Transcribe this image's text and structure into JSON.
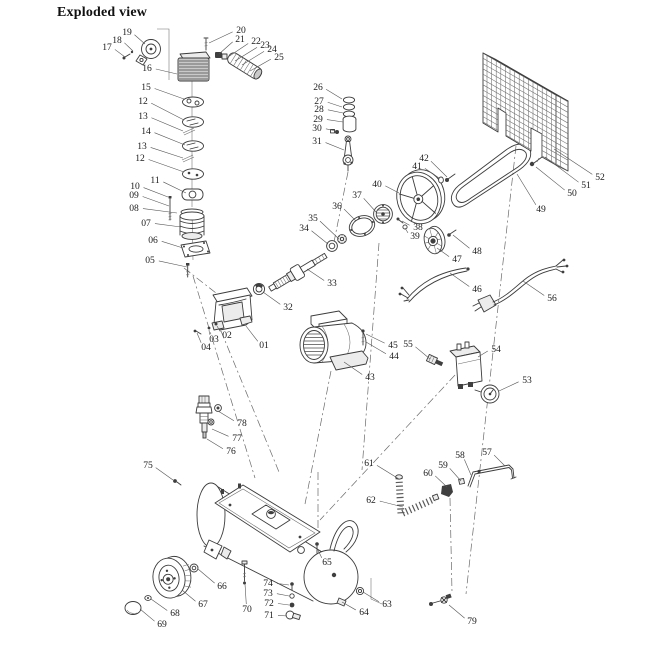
{
  "title": "Exploded view",
  "diagram": {
    "type": "exploded-parts-diagram",
    "subject": "belt-driven air compressor",
    "ink_color": "#3c3c3c",
    "label_color": "#1c1c1c",
    "labels": [
      {
        "n": "19",
        "x": 127,
        "y": 32,
        "tx": 145,
        "ty": 44
      },
      {
        "n": "18",
        "x": 117,
        "y": 40,
        "tx": 133,
        "ty": 51
      },
      {
        "n": "17",
        "x": 107,
        "y": 47,
        "tx": 125,
        "ty": 57
      },
      {
        "n": "16",
        "x": 147,
        "y": 68,
        "tx": 177,
        "ty": 74
      },
      {
        "n": "15",
        "x": 146,
        "y": 87,
        "tx": 184,
        "ty": 99
      },
      {
        "n": "12",
        "x": 143,
        "y": 101,
        "tx": 184,
        "ty": 120
      },
      {
        "n": "13",
        "x": 143,
        "y": 116,
        "tx": 183,
        "ty": 131
      },
      {
        "n": "14",
        "x": 146,
        "y": 131,
        "tx": 185,
        "ty": 145
      },
      {
        "n": "13",
        "x": 142,
        "y": 146,
        "tx": 183,
        "ty": 158
      },
      {
        "n": "12",
        "x": 140,
        "y": 158,
        "tx": 184,
        "ty": 172
      },
      {
        "n": "11",
        "x": 155,
        "y": 180,
        "tx": 186,
        "ty": 193
      },
      {
        "n": "10",
        "x": 135,
        "y": 186,
        "tx": 168,
        "ty": 197
      },
      {
        "n": "09",
        "x": 134,
        "y": 195,
        "tx": 169,
        "ty": 206
      },
      {
        "n": "08",
        "x": 134,
        "y": 208,
        "tx": 177,
        "ty": 213
      },
      {
        "n": "07",
        "x": 146,
        "y": 223,
        "tx": 181,
        "ty": 227
      },
      {
        "n": "06",
        "x": 153,
        "y": 240,
        "tx": 183,
        "ty": 248
      },
      {
        "n": "05",
        "x": 150,
        "y": 260,
        "tx": 187,
        "ty": 267
      },
      {
        "n": "01",
        "x": 264,
        "y": 345,
        "tx": 246,
        "ty": 326
      },
      {
        "n": "02",
        "x": 227,
        "y": 335,
        "tx": 217,
        "ty": 326
      },
      {
        "n": "03",
        "x": 214,
        "y": 339,
        "tx": 209,
        "ty": 330
      },
      {
        "n": "04",
        "x": 206,
        "y": 347,
        "tx": 197,
        "ty": 333
      },
      {
        "n": "20",
        "x": 241,
        "y": 30,
        "tx": 209,
        "ty": 43
      },
      {
        "n": "21",
        "x": 240,
        "y": 39,
        "tx": 219,
        "ty": 54
      },
      {
        "n": "22",
        "x": 256,
        "y": 41,
        "tx": 228,
        "ty": 57
      },
      {
        "n": "23",
        "x": 265,
        "y": 45,
        "tx": 235,
        "ty": 61
      },
      {
        "n": "24",
        "x": 272,
        "y": 49,
        "tx": 242,
        "ty": 65
      },
      {
        "n": "25",
        "x": 279,
        "y": 57,
        "tx": 250,
        "ty": 71
      },
      {
        "n": "26",
        "x": 318,
        "y": 87,
        "tx": 342,
        "ty": 99
      },
      {
        "n": "27",
        "x": 319,
        "y": 101,
        "tx": 342,
        "ty": 107
      },
      {
        "n": "28",
        "x": 319,
        "y": 109,
        "tx": 343,
        "ty": 113
      },
      {
        "n": "29",
        "x": 318,
        "y": 119,
        "tx": 343,
        "ty": 122
      },
      {
        "n": "30",
        "x": 317,
        "y": 128,
        "tx": 336,
        "ty": 131
      },
      {
        "n": "31",
        "x": 317,
        "y": 141,
        "tx": 344,
        "ty": 150
      },
      {
        "n": "32",
        "x": 288,
        "y": 307,
        "tx": 263,
        "ty": 292
      },
      {
        "n": "33",
        "x": 332,
        "y": 283,
        "tx": 307,
        "ty": 269
      },
      {
        "n": "34",
        "x": 304,
        "y": 228,
        "tx": 328,
        "ty": 244
      },
      {
        "n": "35",
        "x": 313,
        "y": 218,
        "tx": 339,
        "ty": 239
      },
      {
        "n": "36",
        "x": 337,
        "y": 206,
        "tx": 356,
        "ty": 221
      },
      {
        "n": "37",
        "x": 357,
        "y": 195,
        "tx": 376,
        "ty": 212
      },
      {
        "n": "38",
        "x": 418,
        "y": 227,
        "tx": 402,
        "ty": 221
      },
      {
        "n": "39",
        "x": 415,
        "y": 236,
        "tx": 405,
        "ty": 228
      },
      {
        "n": "40",
        "x": 377,
        "y": 184,
        "tx": 399,
        "ty": 193
      },
      {
        "n": "41",
        "x": 417,
        "y": 166,
        "tx": 439,
        "ty": 178
      },
      {
        "n": "42",
        "x": 424,
        "y": 158,
        "tx": 447,
        "ty": 177
      },
      {
        "n": "43",
        "x": 370,
        "y": 377,
        "tx": 344,
        "ty": 362
      },
      {
        "n": "44",
        "x": 394,
        "y": 356,
        "tx": 366,
        "ty": 342
      },
      {
        "n": "45",
        "x": 393,
        "y": 345,
        "tx": 366,
        "ty": 334
      },
      {
        "n": "55",
        "x": 408,
        "y": 344,
        "tx": 430,
        "ty": 359
      },
      {
        "n": "54",
        "x": 496,
        "y": 349,
        "tx": 478,
        "ty": 357
      },
      {
        "n": "53",
        "x": 527,
        "y": 380,
        "tx": 499,
        "ty": 391
      },
      {
        "n": "46",
        "x": 477,
        "y": 289,
        "tx": 450,
        "ty": 273
      },
      {
        "n": "47",
        "x": 457,
        "y": 259,
        "tx": 437,
        "ty": 248
      },
      {
        "n": "48",
        "x": 477,
        "y": 251,
        "tx": 453,
        "ty": 235
      },
      {
        "n": "49",
        "x": 541,
        "y": 209,
        "tx": 517,
        "ty": 174
      },
      {
        "n": "50",
        "x": 572,
        "y": 193,
        "tx": 536,
        "ty": 167
      },
      {
        "n": "51",
        "x": 586,
        "y": 185,
        "tx": 545,
        "ty": 157
      },
      {
        "n": "52",
        "x": 600,
        "y": 177,
        "tx": 554,
        "ty": 149
      },
      {
        "n": "56",
        "x": 552,
        "y": 298,
        "tx": 523,
        "ty": 281
      },
      {
        "n": "57",
        "x": 487,
        "y": 452,
        "tx": 505,
        "ty": 466
      },
      {
        "n": "58",
        "x": 460,
        "y": 455,
        "tx": 471,
        "ty": 475
      },
      {
        "n": "59",
        "x": 443,
        "y": 465,
        "tx": 461,
        "ty": 481
      },
      {
        "n": "60",
        "x": 428,
        "y": 473,
        "tx": 447,
        "ty": 487
      },
      {
        "n": "61",
        "x": 369,
        "y": 463,
        "tx": 399,
        "ty": 479
      },
      {
        "n": "62",
        "x": 371,
        "y": 500,
        "tx": 403,
        "ty": 507
      },
      {
        "n": "63",
        "x": 387,
        "y": 604,
        "tx": 363,
        "ty": 592
      },
      {
        "n": "64",
        "x": 364,
        "y": 612,
        "tx": 342,
        "ty": 602
      },
      {
        "n": "65",
        "x": 327,
        "y": 562,
        "tx": 317,
        "ty": 548
      },
      {
        "n": "66",
        "x": 222,
        "y": 586,
        "tx": 198,
        "ty": 569
      },
      {
        "n": "67",
        "x": 203,
        "y": 604,
        "tx": 182,
        "ty": 590
      },
      {
        "n": "68",
        "x": 175,
        "y": 613,
        "tx": 151,
        "ty": 599
      },
      {
        "n": "69",
        "x": 162,
        "y": 624,
        "tx": 140,
        "ty": 609
      },
      {
        "n": "70",
        "x": 247,
        "y": 609,
        "tx": 245,
        "ty": 584
      },
      {
        "n": "71",
        "x": 269,
        "y": 615,
        "tx": 287,
        "ty": 616
      },
      {
        "n": "72",
        "x": 269,
        "y": 603,
        "tx": 289,
        "ty": 605
      },
      {
        "n": "73",
        "x": 268,
        "y": 593,
        "tx": 289,
        "ty": 596
      },
      {
        "n": "74",
        "x": 268,
        "y": 583,
        "tx": 289,
        "ty": 585
      },
      {
        "n": "75",
        "x": 148,
        "y": 465,
        "tx": 173,
        "ty": 480
      },
      {
        "n": "76",
        "x": 231,
        "y": 451,
        "tx": 207,
        "ty": 439
      },
      {
        "n": "77",
        "x": 237,
        "y": 438,
        "tx": 212,
        "ty": 429
      },
      {
        "n": "78",
        "x": 242,
        "y": 423,
        "tx": 218,
        "ty": 411
      },
      {
        "n": "79",
        "x": 472,
        "y": 621,
        "tx": 449,
        "ty": 605
      }
    ]
  }
}
